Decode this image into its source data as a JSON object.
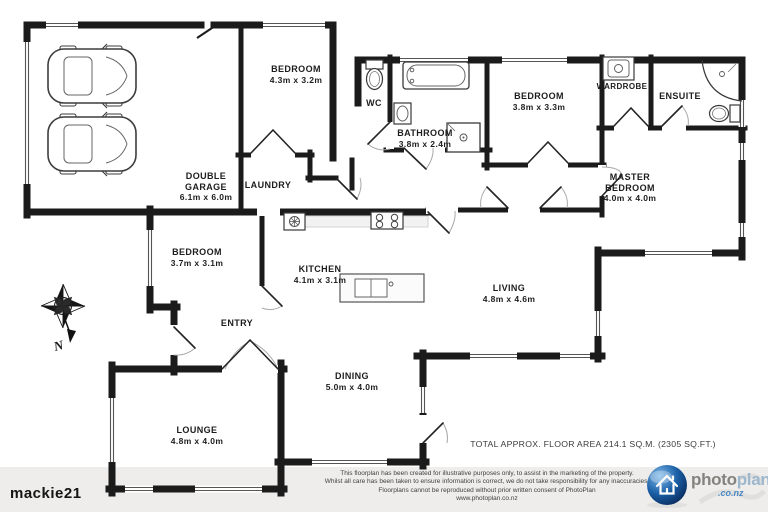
{
  "page": {
    "watermark": "mackie21"
  },
  "compass": {
    "label": "N"
  },
  "rooms": {
    "garage": {
      "line1": "DOUBLE",
      "line2": "GARAGE",
      "dims": "6.1m x 6.0m"
    },
    "bedroom_top": {
      "label": "BEDROOM",
      "dims": "4.3m x 3.2m"
    },
    "wc": {
      "label": "WC"
    },
    "laundry": {
      "label": "LAUNDRY"
    },
    "bathroom": {
      "label": "BATHROOM",
      "dims": "3.8m x 2.4m"
    },
    "bedroom_mid": {
      "label": "BEDROOM",
      "dims": "3.8m x 3.3m"
    },
    "wardrobe": {
      "label": "WARDROBE"
    },
    "ensuite": {
      "label": "ENSUITE"
    },
    "master": {
      "line1": "MASTER",
      "line2": "BEDROOM",
      "dims": "4.0m x 4.0m"
    },
    "bedroom_left": {
      "label": "BEDROOM",
      "dims": "3.7m x 3.1m"
    },
    "kitchen": {
      "label": "KITCHEN",
      "dims": "4.1m x 3.1m"
    },
    "entry": {
      "label": "ENTRY"
    },
    "living": {
      "label": "LIVING",
      "dims": "4.8m x 4.6m"
    },
    "dining": {
      "label": "DINING",
      "dims": "5.0m x 4.0m"
    },
    "lounge": {
      "label": "LOUNGE",
      "dims": "4.8m x 4.0m"
    }
  },
  "summary": {
    "total_area": "TOTAL APPROX. FLOOR AREA 214.1 SQ.M. (2305 SQ.FT.)"
  },
  "footer": {
    "disclaimer": [
      "This floorplan has been created for illustrative purposes only, to assist in the marketing of the property.",
      "Whilst all care has been taken to ensure information is correct, we do not take responsibility for any inaccuracies.",
      "Floorplans cannot be reproduced without prior written consent of PhotoPlan",
      "www.photoplan.co.nz"
    ],
    "brand": {
      "word_gray": "photo",
      "word_blue": "plan",
      "domain": ".co.nz"
    }
  },
  "colors": {
    "wall": "#1b1b1b",
    "logo_sphere": "#1b5fa6",
    "logo_domain": "#4a86c2"
  }
}
